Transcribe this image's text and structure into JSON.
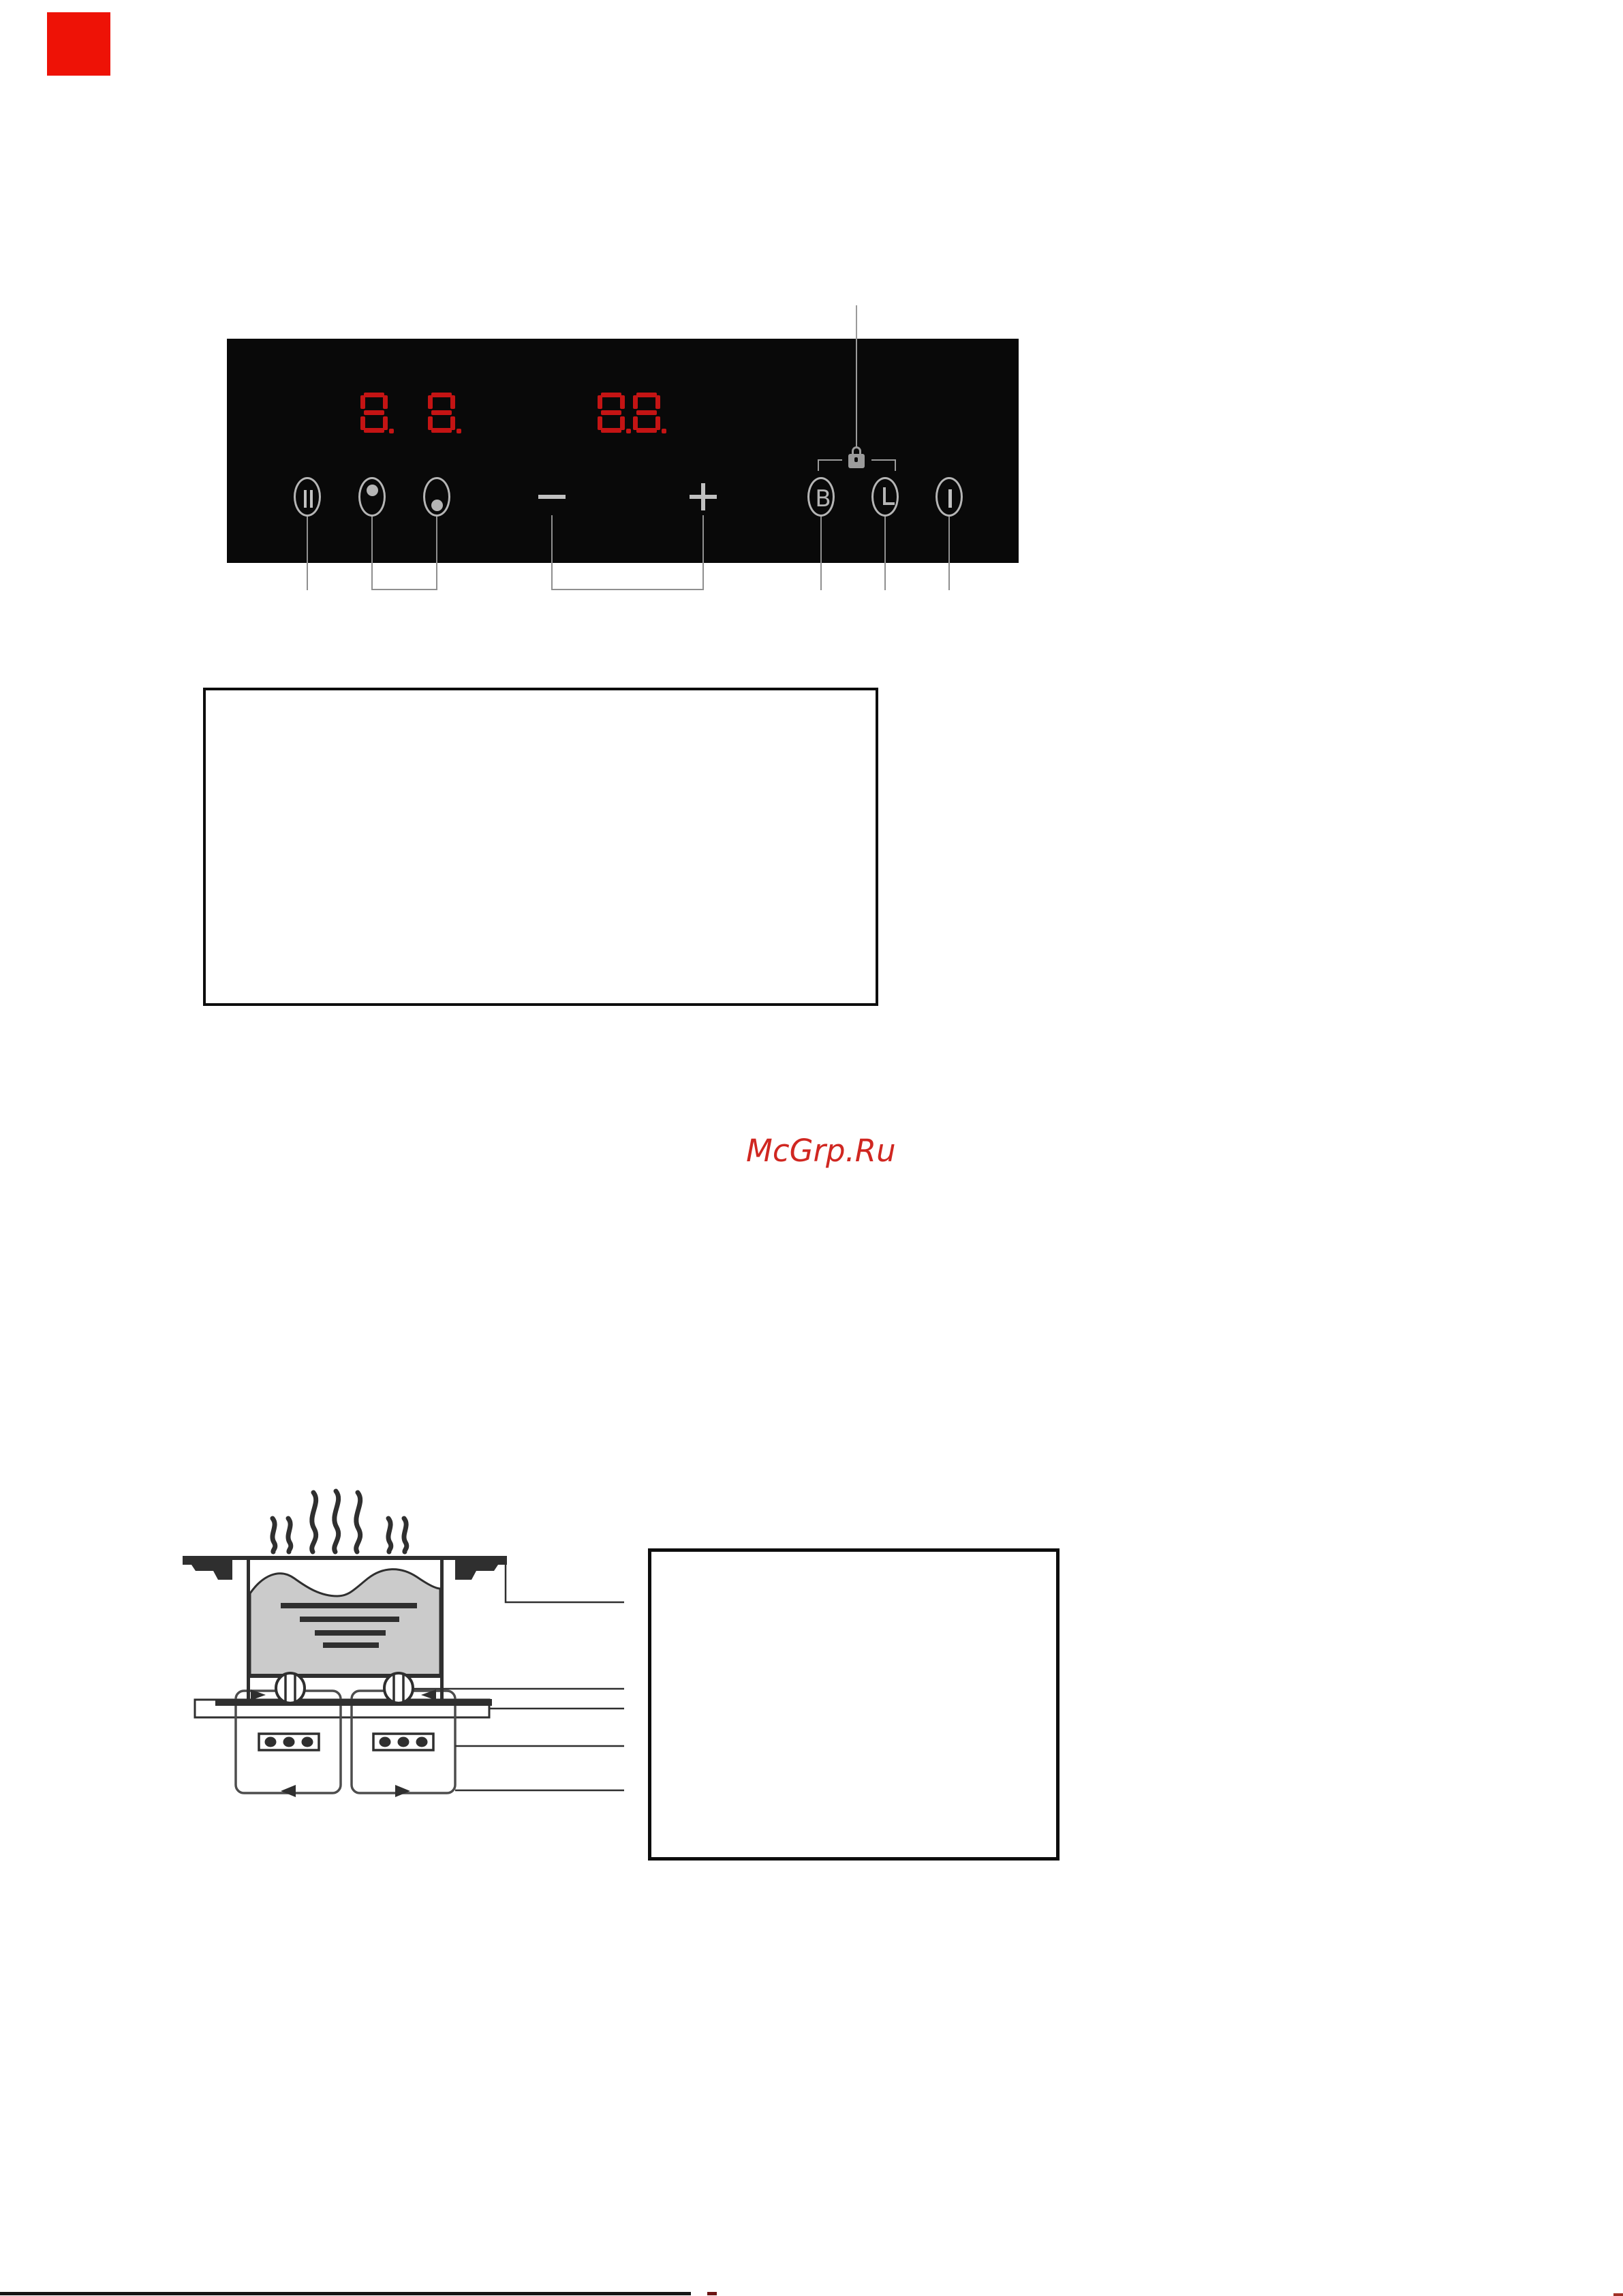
{
  "page": {
    "background": "#ffffff",
    "kind": "appliance manual page"
  },
  "corner_marker": {
    "color": "#ee1206"
  },
  "watermark": {
    "text": "McGrp.Ru",
    "color": "#d02721"
  },
  "control_panel": {
    "background": "#090909",
    "display_color": "#c41414",
    "symbol_color": "#b5b5b5",
    "displays": {
      "cooking_zone_display": {
        "value": "8.8.",
        "digits": [
          "8.",
          "8."
        ]
      },
      "timer_display": {
        "value": "8.8.",
        "digits": [
          "8.",
          "8."
        ]
      }
    },
    "keys": [
      {
        "id": "pause",
        "symbol": "II"
      },
      {
        "id": "zone-select-front",
        "symbol": "upper dot in ellipse"
      },
      {
        "id": "zone-select-rear",
        "symbol": "lower dot in ellipse"
      },
      {
        "id": "minus",
        "symbol": "−"
      },
      {
        "id": "plus",
        "symbol": "+"
      },
      {
        "id": "booster",
        "symbol": "B"
      },
      {
        "id": "timer",
        "symbol": "clock"
      },
      {
        "id": "power",
        "symbol": "|"
      }
    ],
    "lock_icon": "padlock between booster and timer keys"
  },
  "diagram": {
    "subject": "induction hob cross-section",
    "elements": [
      "steam",
      "worktop edges",
      "pot with boiling liquid",
      "induction coils",
      "glass-ceramic plate",
      "two generator units with terminal blocks",
      "air-flow arrows",
      "five callout lines"
    ]
  },
  "note_boxes": {
    "count": 2,
    "content": ""
  },
  "footer": {
    "rule": "black horizontal line, cut off at page bottom"
  }
}
